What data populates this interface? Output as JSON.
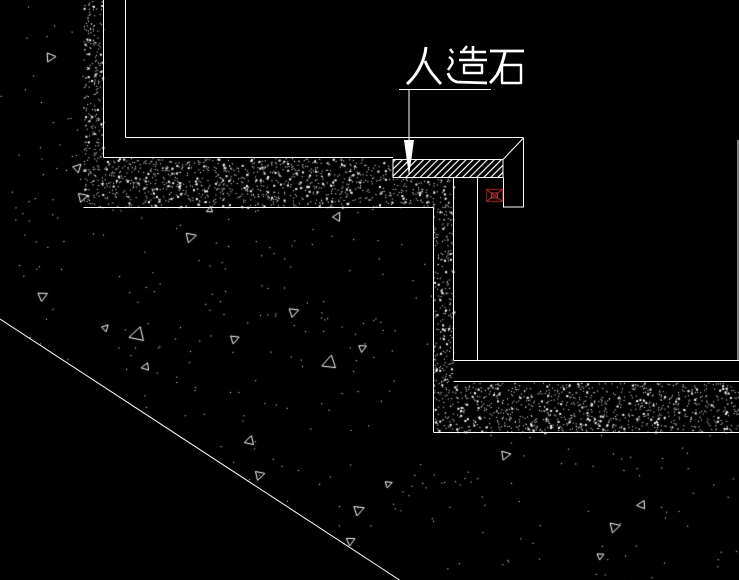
{
  "drawing": {
    "label": "人造石",
    "marker": "box-x-marker",
    "colors": {
      "background": "#000000",
      "linework": "#ffffff",
      "marker_dark": "#7c1b1b",
      "marker_mid": "#952222",
      "marker_bright": "#b83232"
    }
  }
}
